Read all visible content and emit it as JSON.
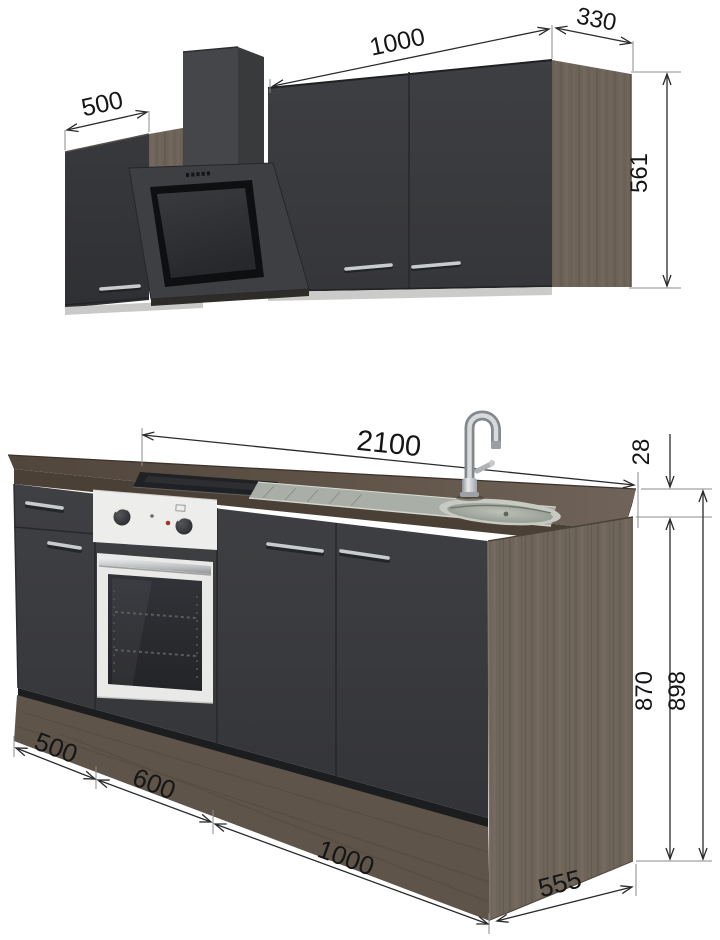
{
  "diagram": {
    "upper_assembly": {
      "left_cabinet_width": "500",
      "right_cabinet_width": "1000",
      "depth": "330",
      "height": "561"
    },
    "base_assembly": {
      "total_width": "2100",
      "worktop_thickness": "28",
      "carcass_height": "870",
      "total_height": "898",
      "left_cabinet_width": "500",
      "oven_cabinet_width": "600",
      "sink_cabinet_width": "1000",
      "depth": "555"
    }
  },
  "colors": {
    "cabinet_front": "#3b3c3e",
    "wood_decor": "#6d6358",
    "worktop": "#5a4e43",
    "dimension_lines": "#2b2b2b",
    "background": "#ffffff"
  }
}
